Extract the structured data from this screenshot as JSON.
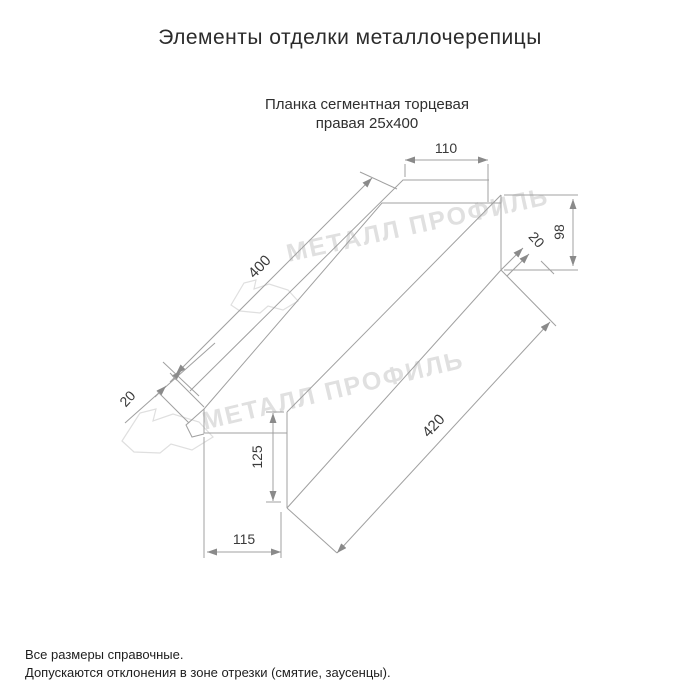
{
  "title": "Элементы отделки металлочерепицы",
  "subtitle": {
    "line1": "Планка сегментная торцевая",
    "line2": "правая 25х400"
  },
  "watermark": {
    "text": "МЕТАЛЛ ПРОФИЛЬ",
    "color": "#e0e0e0"
  },
  "drawing": {
    "line_color": "#a0a0a0",
    "dim_text_color": "#3a3a3a",
    "dimensions": {
      "top_flange_width": "110",
      "top_edge_length": "400",
      "end_height": "98",
      "end_hem": "20",
      "left_hem": "20",
      "front_height": "125",
      "bottom_edge_length": "420",
      "bottom_flange_width": "115"
    }
  },
  "footer": {
    "line1": "Все размеры справочные.",
    "line2": "Допускаются отклонения в зоне отрезки (смятие, заусенцы)."
  }
}
